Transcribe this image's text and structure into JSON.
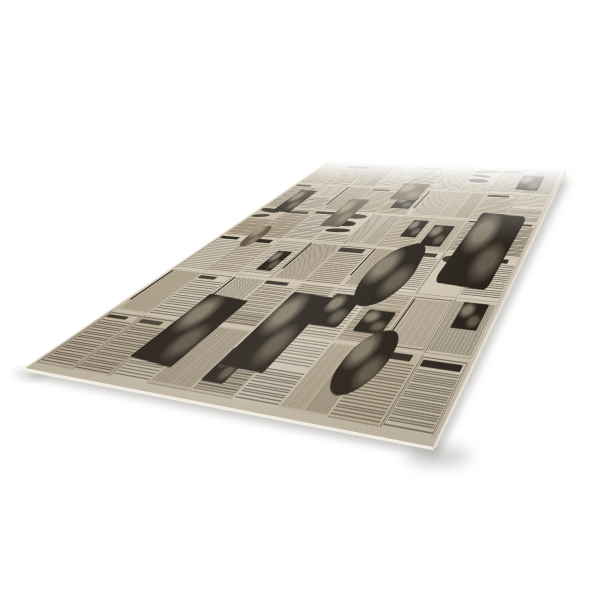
{
  "scene": {
    "background": "#ffffff",
    "subject": "sheet of vintage newspaper-print wrapping paper photographed in perspective",
    "palette": {
      "paper_base": "#cfc4ae",
      "paper_light": "#d9d1bf",
      "paper_dark": "#c3b69d",
      "gutter": "#d3c9b6",
      "ink_text": "#2f261a",
      "ink_headline": "#18130d",
      "photo_dark": "#221c15",
      "photo_mid": "#655947",
      "edge_highlight": "#f3efe4",
      "shadow": "#8e8b86"
    },
    "quad": {
      "far_left": [
        328,
        162
      ],
      "far_right": [
        565,
        170
      ],
      "near_right": [
        433,
        447
      ],
      "near_left": [
        25,
        368
      ]
    },
    "sheet_local_size": [
      880,
      430
    ],
    "texture": {
      "seed": 12,
      "cols": 9,
      "rows": 6,
      "paper_shades": [
        "#c8bca4",
        "#cfc3ad",
        "#d4cab6",
        "#d9d1bf",
        "#cdc0a8"
      ],
      "features": [
        {
          "x": 0.8,
          "y": 0.3,
          "w": 0.15,
          "h": 0.32,
          "rot": 2,
          "br": "6% 10% 8% 12%"
        },
        {
          "x": 0.6,
          "y": 0.48,
          "w": 0.13,
          "h": 0.24,
          "rot": -18,
          "br": "60% 45% 55% 65%"
        },
        {
          "x": 0.45,
          "y": 0.7,
          "w": 0.12,
          "h": 0.22,
          "rot": 1,
          "br": "4%"
        },
        {
          "x": 0.22,
          "y": 0.74,
          "w": 0.13,
          "h": 0.2,
          "rot": 2,
          "br": "4%"
        },
        {
          "x": 0.06,
          "y": 0.22,
          "w": 0.07,
          "h": 0.14,
          "rot": 0,
          "br": "4%"
        },
        {
          "x": 0.1,
          "y": 0.44,
          "w": 0.055,
          "h": 0.11,
          "rot": 0,
          "br": "50%",
          "tone": "mid"
        },
        {
          "x": 0.44,
          "y": 0.14,
          "w": 0.1,
          "h": 0.11,
          "rot": 0,
          "br": "8%",
          "tone": "mid"
        },
        {
          "x": 0.86,
          "y": 0.05,
          "w": 0.08,
          "h": 0.1,
          "rot": 1,
          "br": "5%"
        },
        {
          "x": 0.3,
          "y": 0.26,
          "w": 0.075,
          "h": 0.16,
          "rot": 0,
          "br": "8%",
          "tone": "mid"
        },
        {
          "x": 0.72,
          "y": 0.78,
          "w": 0.1,
          "h": 0.16,
          "rot": -8,
          "br": "50% 40% 55% 45%"
        }
      ]
    }
  }
}
